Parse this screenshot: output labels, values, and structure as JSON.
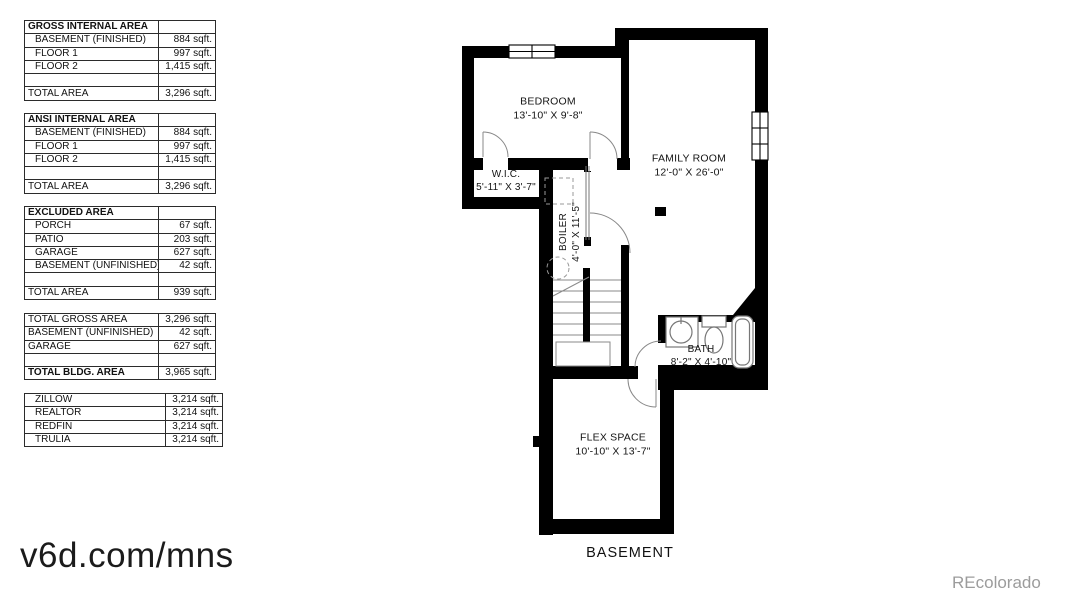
{
  "watermark": "v6d.com/mns",
  "credit": "REcolorado",
  "plan": {
    "floor_label": "BASEMENT",
    "rooms": {
      "bedroom": {
        "name": "BEDROOM",
        "dims": "13'-10\" X 9'-8\""
      },
      "wic": {
        "name": "W.I.C.",
        "dims": "5'-11\" X 3'-7\""
      },
      "boiler": {
        "name": "BOILER",
        "dims": "4'-0\" X 11'-5\""
      },
      "family_room": {
        "name": "FAMILY ROOM",
        "dims": "12'-0\" X 26'-0\""
      },
      "bath": {
        "name": "BATH",
        "dims": "8'-2\" X 4'-10\""
      },
      "flex_space": {
        "name": "FLEX SPACE",
        "dims": "10'-10\" X 13'-7\""
      }
    }
  },
  "tables": [
    {
      "title": "GROSS INTERNAL AREA",
      "rows": [
        {
          "label": "BASEMENT (FINISHED)",
          "value": "884 sqft."
        },
        {
          "label": "FLOOR 1",
          "value": "997 sqft."
        },
        {
          "label": "FLOOR 2",
          "value": "1,415 sqft."
        }
      ],
      "total_label": "TOTAL AREA",
      "total_value": "3,296 sqft."
    },
    {
      "title": "ANSI INTERNAL AREA",
      "rows": [
        {
          "label": "BASEMENT (FINISHED)",
          "value": "884 sqft."
        },
        {
          "label": "FLOOR 1",
          "value": "997 sqft."
        },
        {
          "label": "FLOOR 2",
          "value": "1,415 sqft."
        }
      ],
      "total_label": "TOTAL AREA",
      "total_value": "3,296 sqft."
    },
    {
      "title": "EXCLUDED AREA",
      "rows": [
        {
          "label": "PORCH",
          "value": "67 sqft."
        },
        {
          "label": "PATIO",
          "value": "203 sqft."
        },
        {
          "label": "GARAGE",
          "value": "627 sqft."
        },
        {
          "label": "BASEMENT (UNFINISHED)",
          "value": "42 sqft."
        }
      ],
      "total_label": "TOTAL AREA",
      "total_value": "939 sqft."
    },
    {
      "rows": [
        {
          "label": "TOTAL GROSS AREA",
          "value": "3,296 sqft."
        },
        {
          "label": "BASEMENT (UNFINISHED)",
          "value": "42 sqft."
        },
        {
          "label": "GARAGE",
          "value": "627 sqft."
        }
      ],
      "total_label": "TOTAL BLDG. AREA",
      "total_value": "3,965 sqft."
    },
    {
      "rows": [
        {
          "label": "ZILLOW",
          "value": "3,214 sqft."
        },
        {
          "label": "REALTOR",
          "value": "3,214 sqft."
        },
        {
          "label": "REDFIN",
          "value": "3,214 sqft."
        },
        {
          "label": "TRULIA",
          "value": "3,214 sqft."
        }
      ]
    }
  ]
}
